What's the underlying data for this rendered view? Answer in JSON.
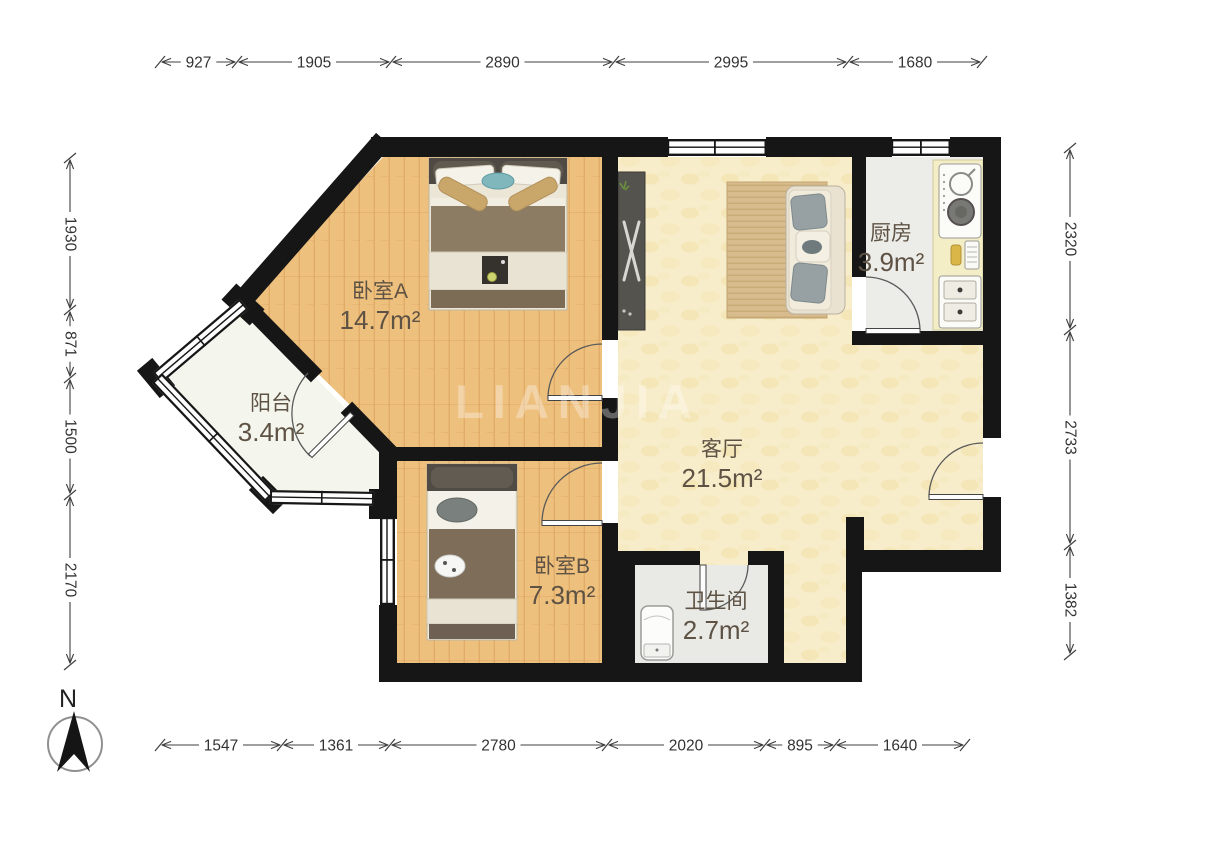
{
  "floorplan": {
    "watermark": "LIANJIA",
    "compass": {
      "label": "N"
    },
    "rooms": [
      {
        "id": "bedroom-a",
        "name": "卧室A",
        "area": "14.7m²",
        "x": 380,
        "y": 298
      },
      {
        "id": "balcony",
        "name": "阳台",
        "area": "3.4m²",
        "x": 271,
        "y": 410
      },
      {
        "id": "bedroom-b",
        "name": "卧室B",
        "area": "7.3m²",
        "x": 562,
        "y": 573
      },
      {
        "id": "living-room",
        "name": "客厅",
        "area": "21.5m²",
        "x": 722,
        "y": 456
      },
      {
        "id": "kitchen",
        "name": "厨房",
        "area": "3.9m²",
        "x": 891,
        "y": 240
      },
      {
        "id": "bathroom",
        "name": "卫生间",
        "area": "2.7m²",
        "x": 716,
        "y": 608
      }
    ],
    "dimensions": {
      "top": {
        "orientation": "h",
        "pos": 62,
        "ticks": [
          160,
          237,
          391,
          614,
          848,
          982
        ],
        "labels": [
          "927",
          "1905",
          "2890",
          "2995",
          "1680"
        ]
      },
      "bottom": {
        "orientation": "h",
        "pos": 745,
        "ticks": [
          160,
          282,
          390,
          607,
          765,
          835,
          965
        ],
        "labels": [
          "1547",
          "1361",
          "2780",
          "2020",
          "895",
          "1640"
        ]
      },
      "left": {
        "orientation": "v",
        "pos": 70,
        "ticks": [
          158,
          310,
          378,
          495,
          665
        ],
        "labels": [
          "1930",
          "871",
          "1500",
          "2170"
        ]
      },
      "right": {
        "orientation": "v",
        "pos": 1070,
        "ticks": [
          148,
          330,
          545,
          655
        ],
        "labels": [
          "2320",
          "2733",
          "1382"
        ]
      }
    },
    "colors": {
      "wall": "#161616",
      "wood_floor": "#eec07d",
      "living_floor": "#f8edca",
      "kitchen_floor": "#ecece8",
      "bath_floor": "#e9e9e5",
      "balcony_floor": "#f4f6ed",
      "label_text": "#5e5244",
      "dimension_text": "#333333",
      "watermark_color": "#ffffff"
    }
  }
}
